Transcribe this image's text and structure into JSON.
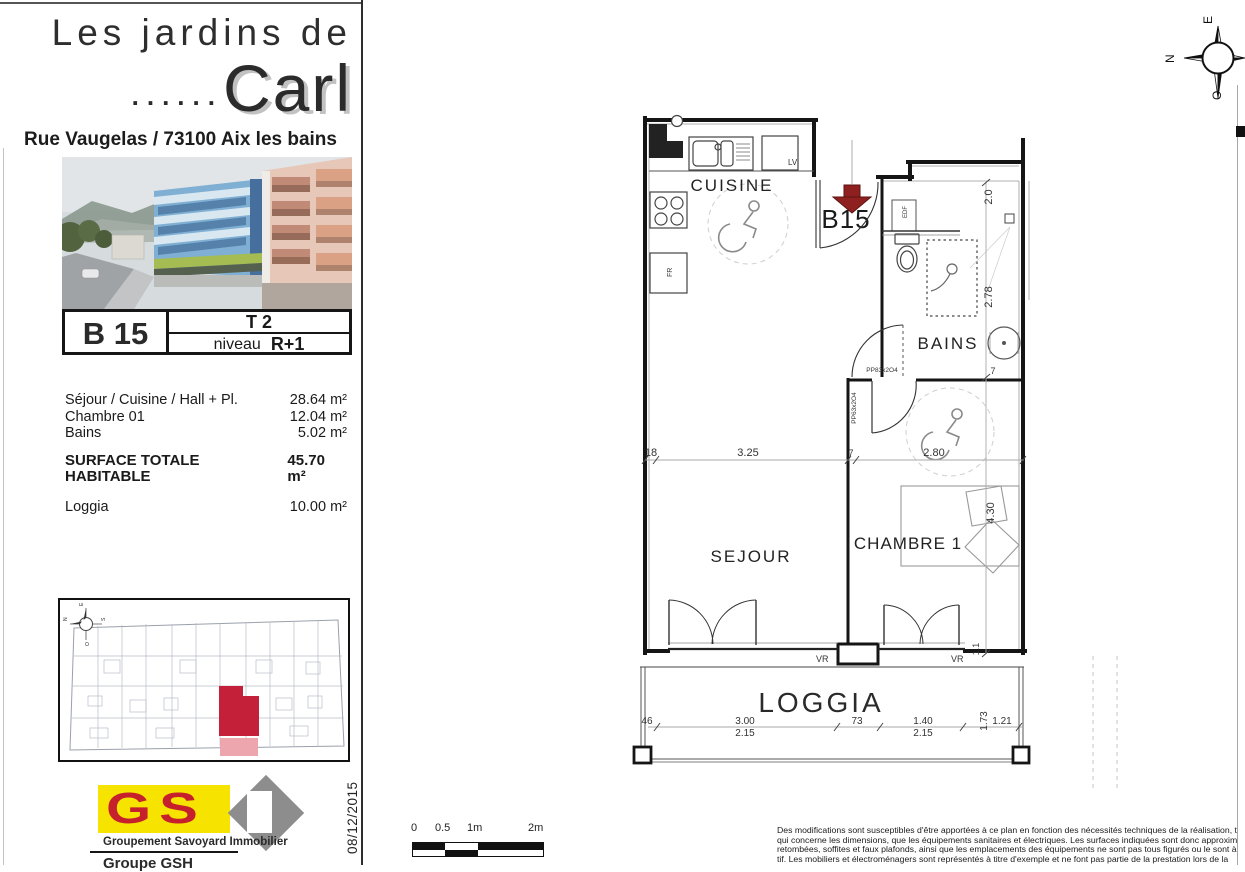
{
  "header": {
    "title_top": "Les jardins de",
    "dots": "......",
    "title_main": "Carl",
    "address": "Rue Vaugelas / 73100 Aix les bains"
  },
  "unit": {
    "code": "B 15",
    "type": "T 2",
    "level_label": "niveau",
    "level": "R+1"
  },
  "surfaces": {
    "rows": [
      {
        "label": "Séjour / Cuisine / Hall + Pl.",
        "value": "28.64 m²"
      },
      {
        "label": "Chambre 01",
        "value": "12.04 m²"
      },
      {
        "label": "Bains",
        "value": "5.02 m²"
      }
    ],
    "total_label": "SURFACE TOTALE HABITABLE",
    "total_value": "45.70 m²",
    "loggia_label": "Loggia",
    "loggia_value": "10.00 m²"
  },
  "floor_plan": {
    "rooms": {
      "kitchen": "CUISINE",
      "bath": "BAINS",
      "living": "SEJOUR",
      "bedroom": "CHAMBRE 1",
      "loggia": "LOGGIA"
    },
    "entrance_label": "B15",
    "tags": {
      "lv": "LV",
      "fr": "FR",
      "edf": "EDF",
      "vr": "VR"
    },
    "doors": {
      "bath_door": "PP83x2O4",
      "bedroom_door": "PP63x2O4"
    },
    "dims_h": [
      "18",
      "3.25",
      "7",
      "2.80"
    ],
    "dims_v": [
      "2.0",
      "2.78",
      "7",
      "4.30",
      "1.1"
    ],
    "loggia_dims": {
      "d0": "46",
      "d1": "3.00",
      "d1b": "2.15",
      "d2": "73",
      "d3": "1.40",
      "d3b": "2.15",
      "d4": "1.73",
      "d5": "1.21"
    },
    "arrow_color": "#8e2020"
  },
  "compass": {
    "top": "E",
    "left": "N",
    "bottom": "O"
  },
  "site_plan": {
    "n": "N",
    "e": "E",
    "s": "S",
    "o": "O"
  },
  "logo": {
    "letters": "GS",
    "caption": "Groupement Savoyard Immobilier",
    "group_line": "Groupe GSH",
    "yellow": "#f6e300",
    "red": "#c5202c",
    "gray": "#8d8d8d"
  },
  "date_label": "08/12/2015",
  "scale_bar": {
    "labels": [
      "0",
      "0.5",
      "1m",
      "2m"
    ]
  },
  "disclaimer": {
    "lines": [
      "Des modifications sont susceptibles d'être apportées à ce plan en fonction des nécessités techniques de la réalisation, t",
      "qui concerne les dimensions, que les équipements sanitaires et électriques. Les surfaces indiquées sont donc approxim",
      "retombées, soffites et faux plafonds, ainsi que les emplacements des équipements ne sont pas tous figurés ou le sont à ti",
      "tif. Les mobiliers et électroménagers sont représentés à titre d'exemple et ne font pas partie de la prestation lors de la"
    ]
  },
  "colors": {
    "highlight_red": "#c5203a",
    "highlight_pink": "#eda6ad",
    "arrow_red": "#8e2020"
  }
}
